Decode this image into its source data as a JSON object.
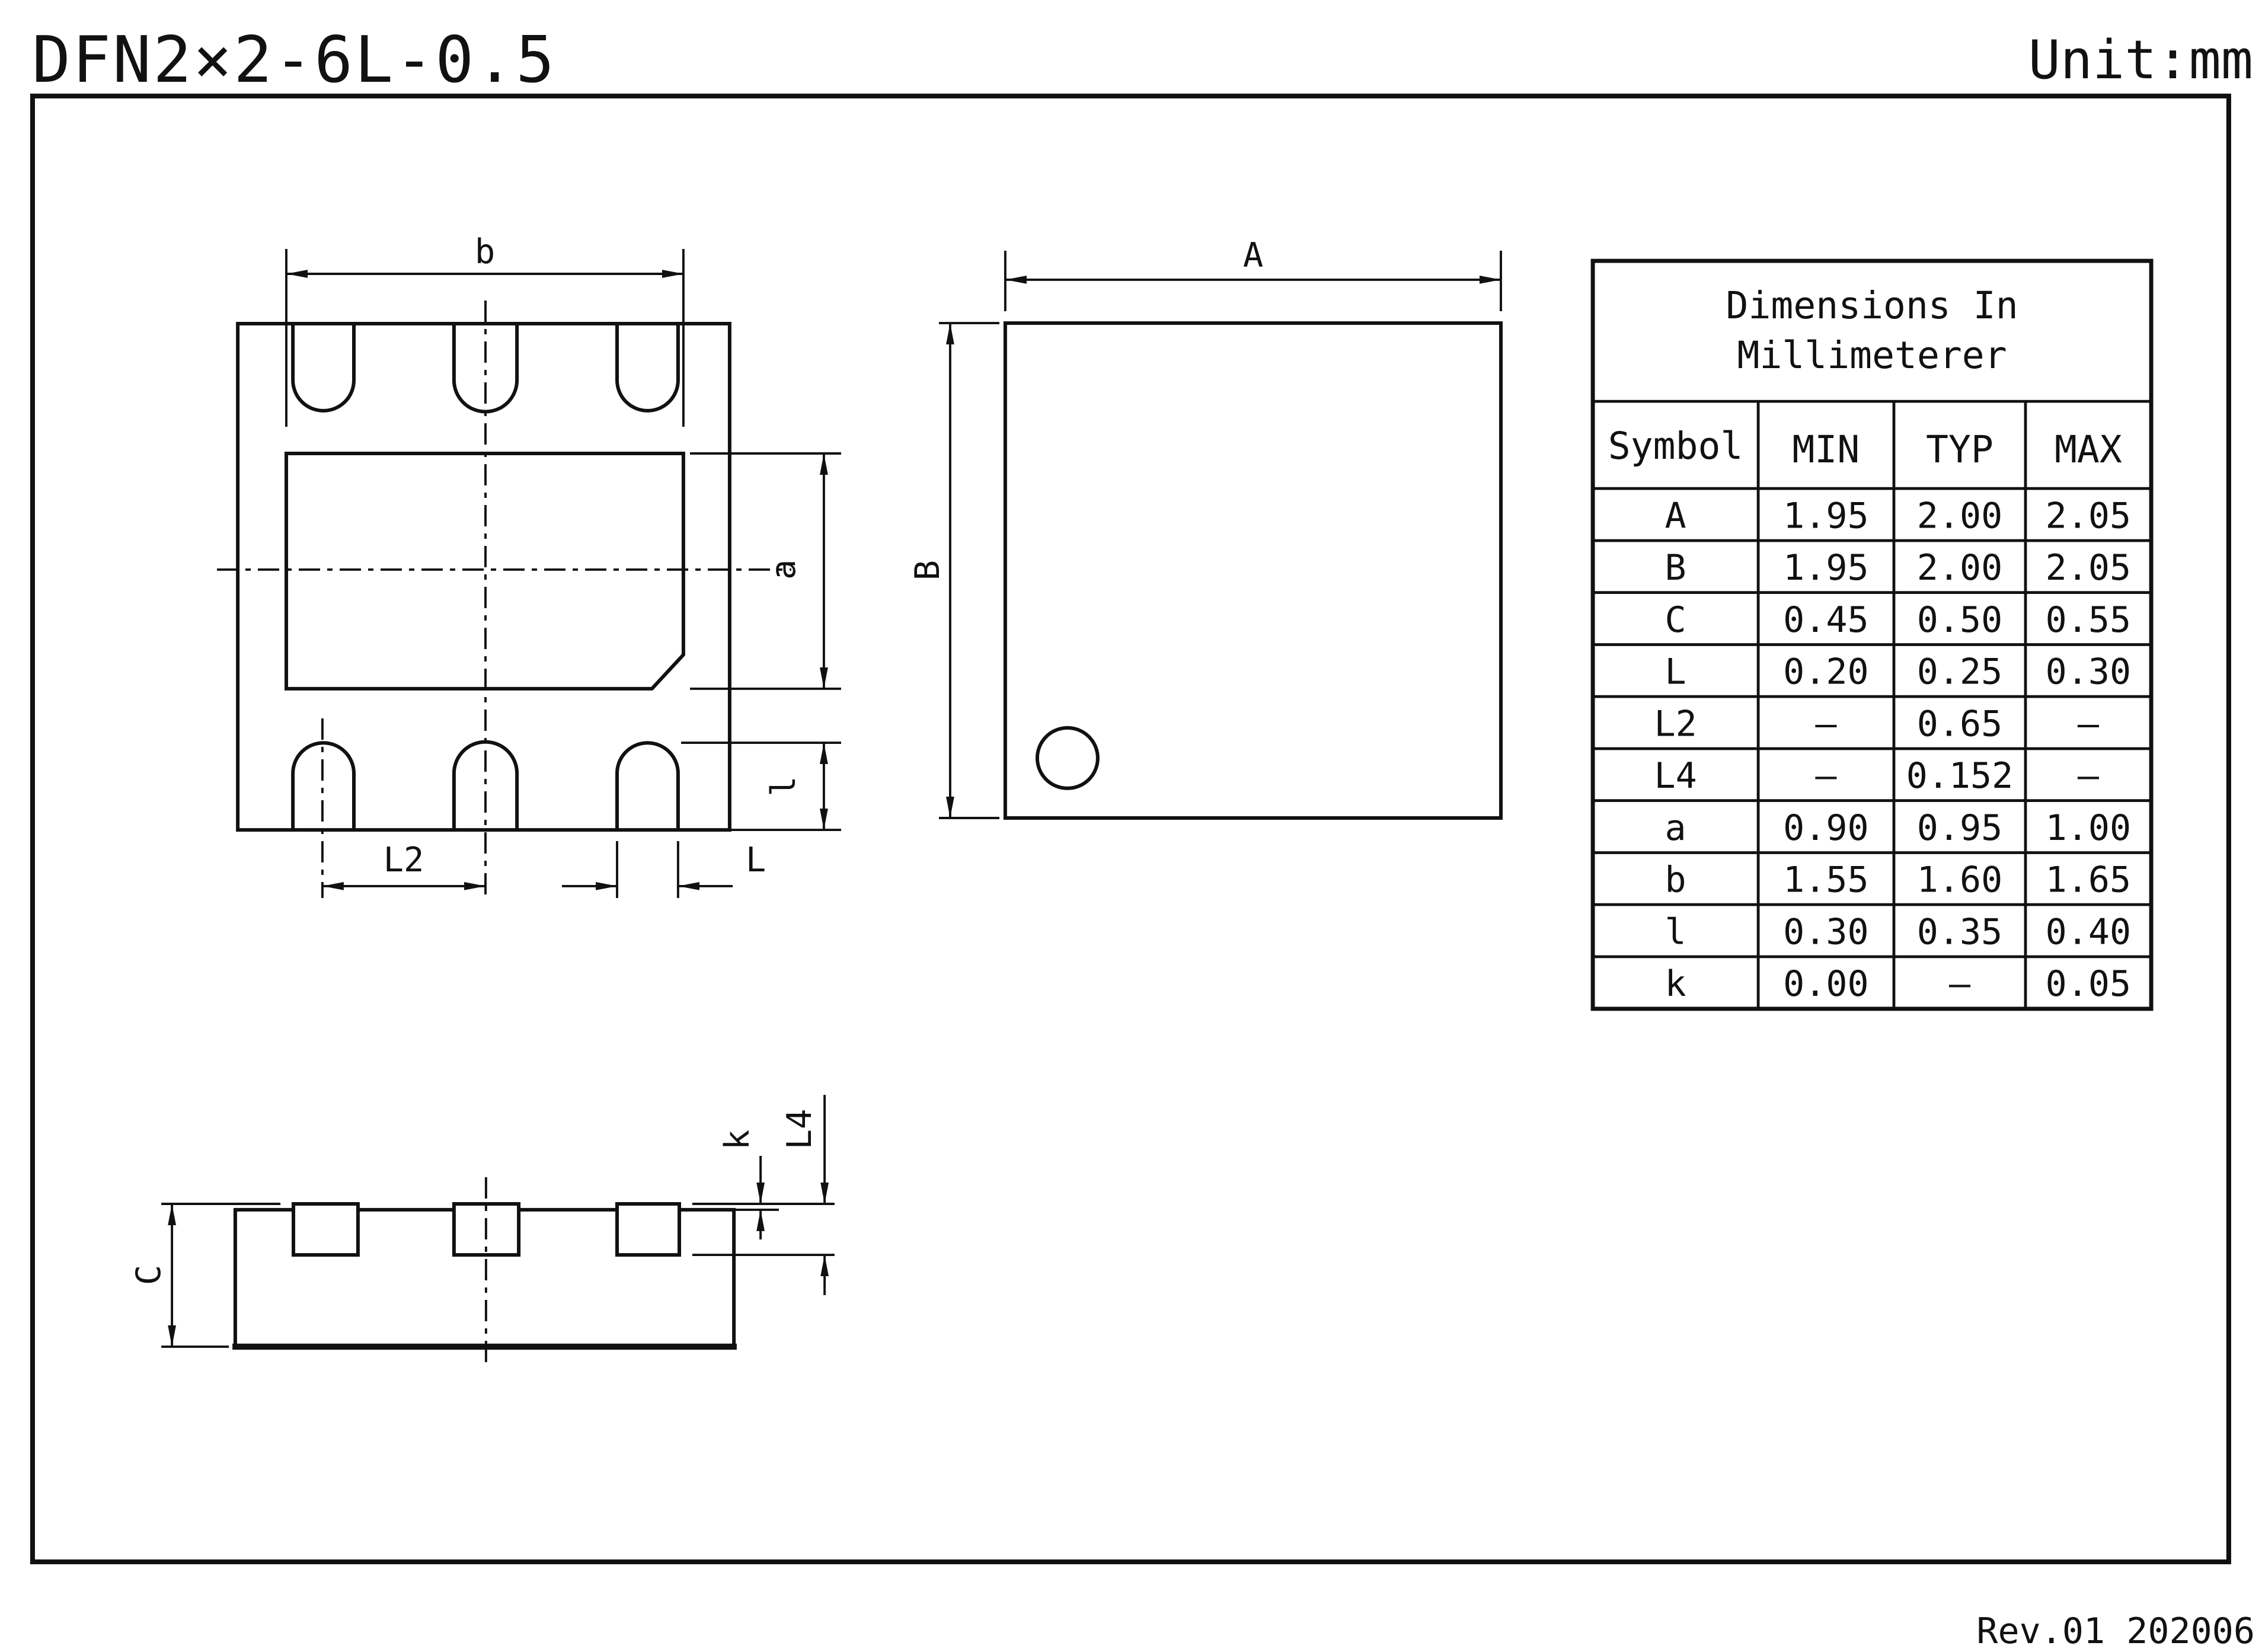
{
  "header": {
    "title": "DFN2×2-6L-0.5",
    "unit_label": "Unit:mm"
  },
  "footer": {
    "revision": "Rev.01 202006"
  },
  "dim_labels": {
    "b": "b",
    "a": "a",
    "l_small": "l",
    "L2": "L2",
    "L": "L",
    "A": "A",
    "B": "B",
    "C": "C",
    "k": "k",
    "L4": "L4"
  },
  "table": {
    "title_line1": "Dimensions In",
    "title_line2": "Millimeterer",
    "columns": [
      "Symbol",
      "MIN",
      "TYP",
      "MAX"
    ],
    "rows": [
      {
        "symbol": "A",
        "min": "1.95",
        "typ": "2.00",
        "max": "2.05"
      },
      {
        "symbol": "B",
        "min": "1.95",
        "typ": "2.00",
        "max": "2.05"
      },
      {
        "symbol": "C",
        "min": "0.45",
        "typ": "0.50",
        "max": "0.55"
      },
      {
        "symbol": "L",
        "min": "0.20",
        "typ": "0.25",
        "max": "0.30"
      },
      {
        "symbol": "L2",
        "min": "–",
        "typ": "0.65",
        "max": "–"
      },
      {
        "symbol": "L4",
        "min": "–",
        "typ": "0.152",
        "max": "–"
      },
      {
        "symbol": "a",
        "min": "0.90",
        "typ": "0.95",
        "max": "1.00"
      },
      {
        "symbol": "b",
        "min": "1.55",
        "typ": "1.60",
        "max": "1.65"
      },
      {
        "symbol": "l",
        "min": "0.30",
        "typ": "0.35",
        "max": "0.40"
      },
      {
        "symbol": "k",
        "min": "0.00",
        "typ": "–",
        "max": "0.05"
      }
    ]
  },
  "colors": {
    "line": "#111111",
    "background": "#ffffff"
  }
}
